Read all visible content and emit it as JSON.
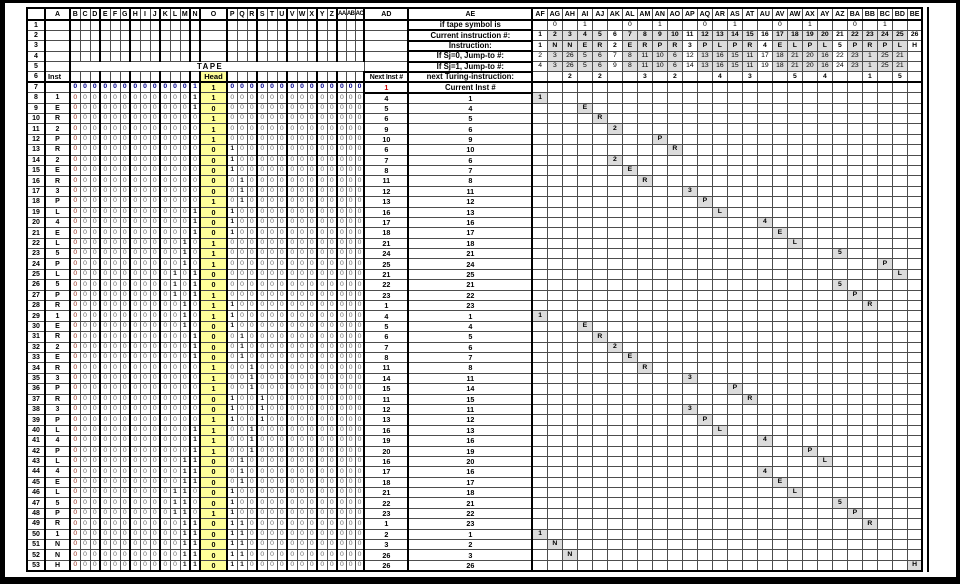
{
  "labels": {
    "tape": "TAPE",
    "head": "Head",
    "inst": "Inst",
    "if_tape_symbol": "if tape symbol is",
    "current_instruction": "Current instruction #:",
    "instruction": "Instruction:",
    "jump0": "If Sj=0, Jump-to #:",
    "jump1": "If Sj=1, Jump-to #:",
    "next_inst": "Next Inst #",
    "next_turing": "next Turing-instruction:",
    "current_inst": "Current Inst #"
  },
  "headers": {
    "left": [
      "",
      "A",
      "B",
      "C",
      "D",
      "E",
      "F",
      "G",
      "H",
      "I",
      "J",
      "K",
      "L",
      "M",
      "N",
      "O",
      "P",
      "Q",
      "R",
      "S",
      "T",
      "U",
      "V",
      "W",
      "X",
      "Y",
      "Z",
      "AA",
      "AB",
      "AC"
    ],
    "right": [
      "AD",
      "AE",
      "AF",
      "AG",
      "AH",
      "AI",
      "AJ",
      "AK",
      "AL",
      "AM",
      "AN",
      "AO",
      "AP",
      "AQ",
      "AR",
      "AS",
      "AT",
      "AU",
      "AV",
      "AW",
      "AX",
      "AY",
      "AZ",
      "BA",
      "BB",
      "BC",
      "BD",
      "BE"
    ]
  },
  "program": {
    "numbers": [
      "1",
      "2",
      "3",
      "4",
      "5",
      "6",
      "7",
      "8",
      "9",
      "10",
      "11",
      "12",
      "13",
      "14",
      "15",
      "16",
      "17",
      "18",
      "19",
      "20",
      "21",
      "22",
      "23",
      "24",
      "25",
      "26"
    ],
    "instructions": [
      "1",
      "N",
      "N",
      "E",
      "R",
      "2",
      "E",
      "R",
      "P",
      "R",
      "3",
      "P",
      "L",
      "P",
      "R",
      "4",
      "E",
      "L",
      "P",
      "L",
      "5",
      "P",
      "R",
      "P",
      "L",
      "H"
    ],
    "jump0": [
      "2",
      "3",
      "26",
      "5",
      "6",
      "7",
      "8",
      "11",
      "10",
      "6",
      "12",
      "13",
      "16",
      "15",
      "11",
      "17",
      "18",
      "21",
      "20",
      "16",
      "22",
      "23",
      "1",
      "25",
      "21",
      ""
    ],
    "jump1": [
      "4",
      "3",
      "26",
      "5",
      "6",
      "9",
      "8",
      "11",
      "10",
      "6",
      "14",
      "13",
      "16",
      "15",
      "11",
      "19",
      "18",
      "21",
      "20",
      "16",
      "24",
      "23",
      "1",
      "25",
      "21",
      ""
    ],
    "symbol_markers": [
      "",
      "0",
      "",
      "1",
      "",
      "",
      "0",
      "",
      "1",
      "",
      "",
      "0",
      "",
      "1",
      "",
      "",
      "0",
      "",
      "1",
      "",
      "",
      "0",
      "",
      "1",
      "",
      ""
    ],
    "next_state": [
      "",
      "",
      "2",
      "",
      "2",
      "",
      "",
      "3",
      "",
      "2",
      "",
      "",
      "4",
      "",
      "3",
      "",
      "",
      "5",
      "",
      "4",
      "",
      "",
      "1",
      "",
      "5",
      ""
    ],
    "test_columns": [
      0,
      5,
      10,
      15,
      20,
      25
    ]
  },
  "initial": {
    "row": "7",
    "tape": "0000000000001100000000000000",
    "next": "1"
  },
  "steps": [
    {
      "r": "8",
      "cur": "1",
      "next": "4",
      "tape": "0000000000001100000000000000"
    },
    {
      "r": "9",
      "cur": "4",
      "next": "5",
      "tape": "0000000000001000000000000000"
    },
    {
      "r": "10",
      "cur": "5",
      "next": "6",
      "tape": "0000000000000100000000000000"
    },
    {
      "r": "11",
      "cur": "6",
      "next": "9",
      "tape": "0000000000000100000000000000"
    },
    {
      "r": "12",
      "cur": "9",
      "next": "10",
      "tape": "0000000000000100000000000000"
    },
    {
      "r": "13",
      "cur": "10",
      "next": "6",
      "tape": "0000000000000010000000000000"
    },
    {
      "r": "14",
      "cur": "6",
      "next": "7",
      "tape": "0000000000000010000000000000"
    },
    {
      "r": "15",
      "cur": "7",
      "next": "8",
      "tape": "0000000000000010000000000000"
    },
    {
      "r": "16",
      "cur": "8",
      "next": "11",
      "tape": "0000000000000001000000000000"
    },
    {
      "r": "17",
      "cur": "11",
      "next": "12",
      "tape": "0000000000000001000000000000"
    },
    {
      "r": "18",
      "cur": "12",
      "next": "13",
      "tape": "0000000000000101000000000000"
    },
    {
      "r": "19",
      "cur": "13",
      "next": "16",
      "tape": "0000000000001010000000000000"
    },
    {
      "r": "20",
      "cur": "16",
      "next": "17",
      "tape": "0000000000001010000000000000"
    },
    {
      "r": "21",
      "cur": "17",
      "next": "18",
      "tape": "0000000000001010000000000000"
    },
    {
      "r": "22",
      "cur": "18",
      "next": "21",
      "tape": "0000000000010100000000000000"
    },
    {
      "r": "23",
      "cur": "21",
      "next": "24",
      "tape": "0000000000010100000000000000"
    },
    {
      "r": "24",
      "cur": "24",
      "next": "25",
      "tape": "0000000000010100000000000000"
    },
    {
      "r": "25",
      "cur": "25",
      "next": "21",
      "tape": "0000000000101000000000000000"
    },
    {
      "r": "26",
      "cur": "21",
      "next": "22",
      "tape": "0000000000101000000000000000"
    },
    {
      "r": "27",
      "cur": "22",
      "next": "23",
      "tape": "0000000000101100000000000000"
    },
    {
      "r": "28",
      "cur": "23",
      "next": "1",
      "tape": "0000000000010110000000000000"
    },
    {
      "r": "29",
      "cur": "1",
      "next": "4",
      "tape": "0000000000010110000000000000"
    },
    {
      "r": "30",
      "cur": "4",
      "next": "5",
      "tape": "0000000000010010000000000000"
    },
    {
      "r": "31",
      "cur": "5",
      "next": "6",
      "tape": "0000000000001001000000000000"
    },
    {
      "r": "32",
      "cur": "6",
      "next": "7",
      "tape": "0000000000001001000000000000"
    },
    {
      "r": "33",
      "cur": "7",
      "next": "8",
      "tape": "0000000000001001000000000000"
    },
    {
      "r": "34",
      "cur": "8",
      "next": "11",
      "tape": "0000000000000100100000000000"
    },
    {
      "r": "35",
      "cur": "11",
      "next": "14",
      "tape": "0000000000000100100000000000"
    },
    {
      "r": "36",
      "cur": "14",
      "next": "15",
      "tape": "0000000000000100100000000000"
    },
    {
      "r": "37",
      "cur": "15",
      "next": "11",
      "tape": "0000000000000010010000000000"
    },
    {
      "r": "38",
      "cur": "11",
      "next": "12",
      "tape": "0000000000000010010000000000"
    },
    {
      "r": "39",
      "cur": "12",
      "next": "13",
      "tape": "0000000000000110010000000000"
    },
    {
      "r": "40",
      "cur": "13",
      "next": "16",
      "tape": "0000000000001100100000000000"
    },
    {
      "r": "41",
      "cur": "16",
      "next": "19",
      "tape": "0000000000001100100000000000"
    },
    {
      "r": "42",
      "cur": "19",
      "next": "20",
      "tape": "0000000000001100100000000000"
    },
    {
      "r": "43",
      "cur": "20",
      "next": "16",
      "tape": "0000000000011001000000000000"
    },
    {
      "r": "44",
      "cur": "16",
      "next": "17",
      "tape": "0000000000011001000000000000"
    },
    {
      "r": "45",
      "cur": "17",
      "next": "18",
      "tape": "0000000000011001000000000000"
    },
    {
      "r": "46",
      "cur": "18",
      "next": "21",
      "tape": "0000000000110010000000000000"
    },
    {
      "r": "47",
      "cur": "21",
      "next": "22",
      "tape": "0000000000110010000000000000"
    },
    {
      "r": "48",
      "cur": "22",
      "next": "23",
      "tape": "0000000000110110000000000000"
    },
    {
      "r": "49",
      "cur": "23",
      "next": "1",
      "tape": "0000000000011011000000000000"
    },
    {
      "r": "50",
      "cur": "1",
      "next": "2",
      "tape": "0000000000011011000000000000"
    },
    {
      "r": "51",
      "cur": "2",
      "next": "3",
      "tape": "0000000000011011000000000000"
    },
    {
      "r": "52",
      "cur": "3",
      "next": "26",
      "tape": "0000000000011011000000000000"
    },
    {
      "r": "53",
      "cur": "26",
      "next": "26",
      "tape": "0000000000011011000000000000"
    }
  ],
  "colors": {
    "head_bg": "#ffff99",
    "shade": "#dcdcdc",
    "initial_row": "#00008b",
    "left_edge_digit": "#9a3324",
    "alert_red": "#cc0000",
    "zero_digit": "#6d6d6d",
    "grid_line": "#4d4d4d"
  }
}
